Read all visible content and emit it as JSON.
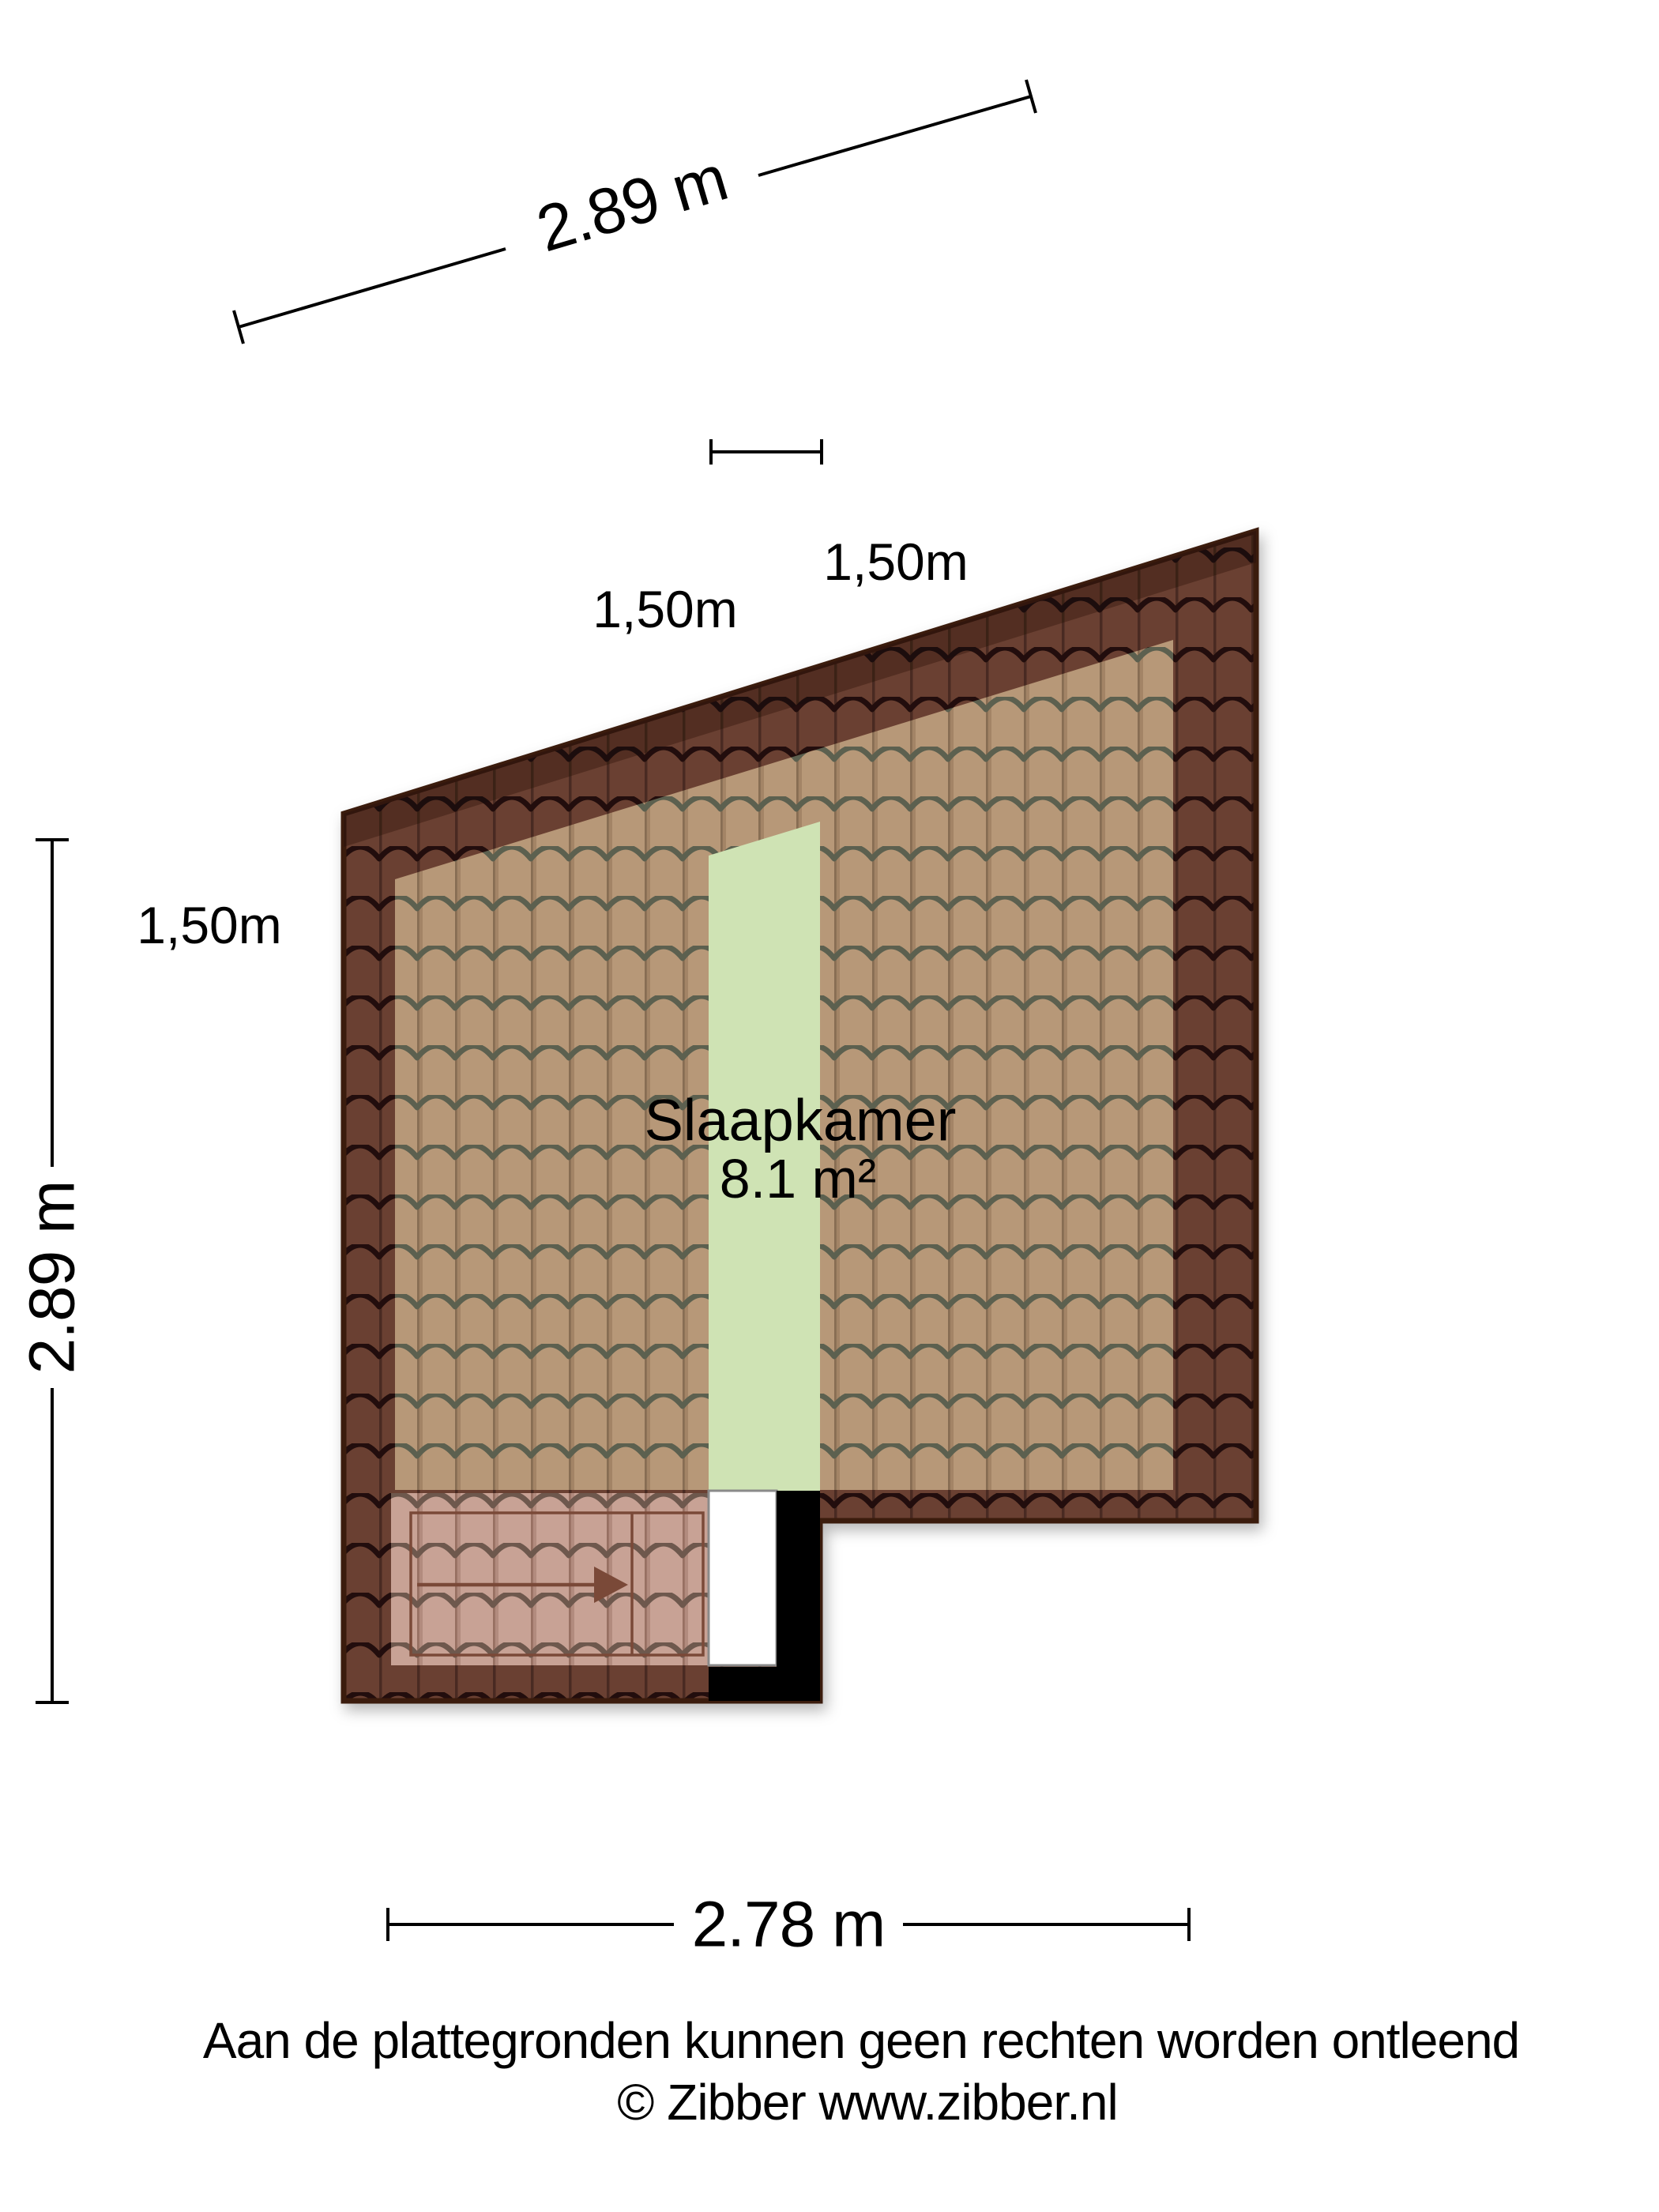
{
  "plan": {
    "room": {
      "name": "Slaapkamer",
      "area": "8.1 m²"
    },
    "dimensions": {
      "top": "2.89 m",
      "left": "2.89 m",
      "bottom": "2.78 m"
    },
    "height_marks": {
      "top_left": "1,50m",
      "top_right": "1,50m",
      "side": "1,50m"
    }
  },
  "footer": {
    "line1": "Aan de plattegronden kunnen geen rechten worden ontleend",
    "line2": "© Zibber www.zibber.nl"
  },
  "colors": {
    "background": "#ffffff",
    "roof_dark_body": "#6b4031",
    "roof_dark_line": "#22100a",
    "roof_dark_edge": "#3a1a0e",
    "roof_tan_body": "#b79878",
    "roof_tan_line": "#5c6150",
    "stair_body": "#c8a295",
    "stair_line": "#6e584e",
    "stair_marking": "#7a4a38",
    "headroom_green": "#cfe3b4",
    "wall_black": "#000000",
    "void_white": "#ffffff",
    "void_border": "#8a8a8a",
    "dimension_text": "#000000"
  }
}
